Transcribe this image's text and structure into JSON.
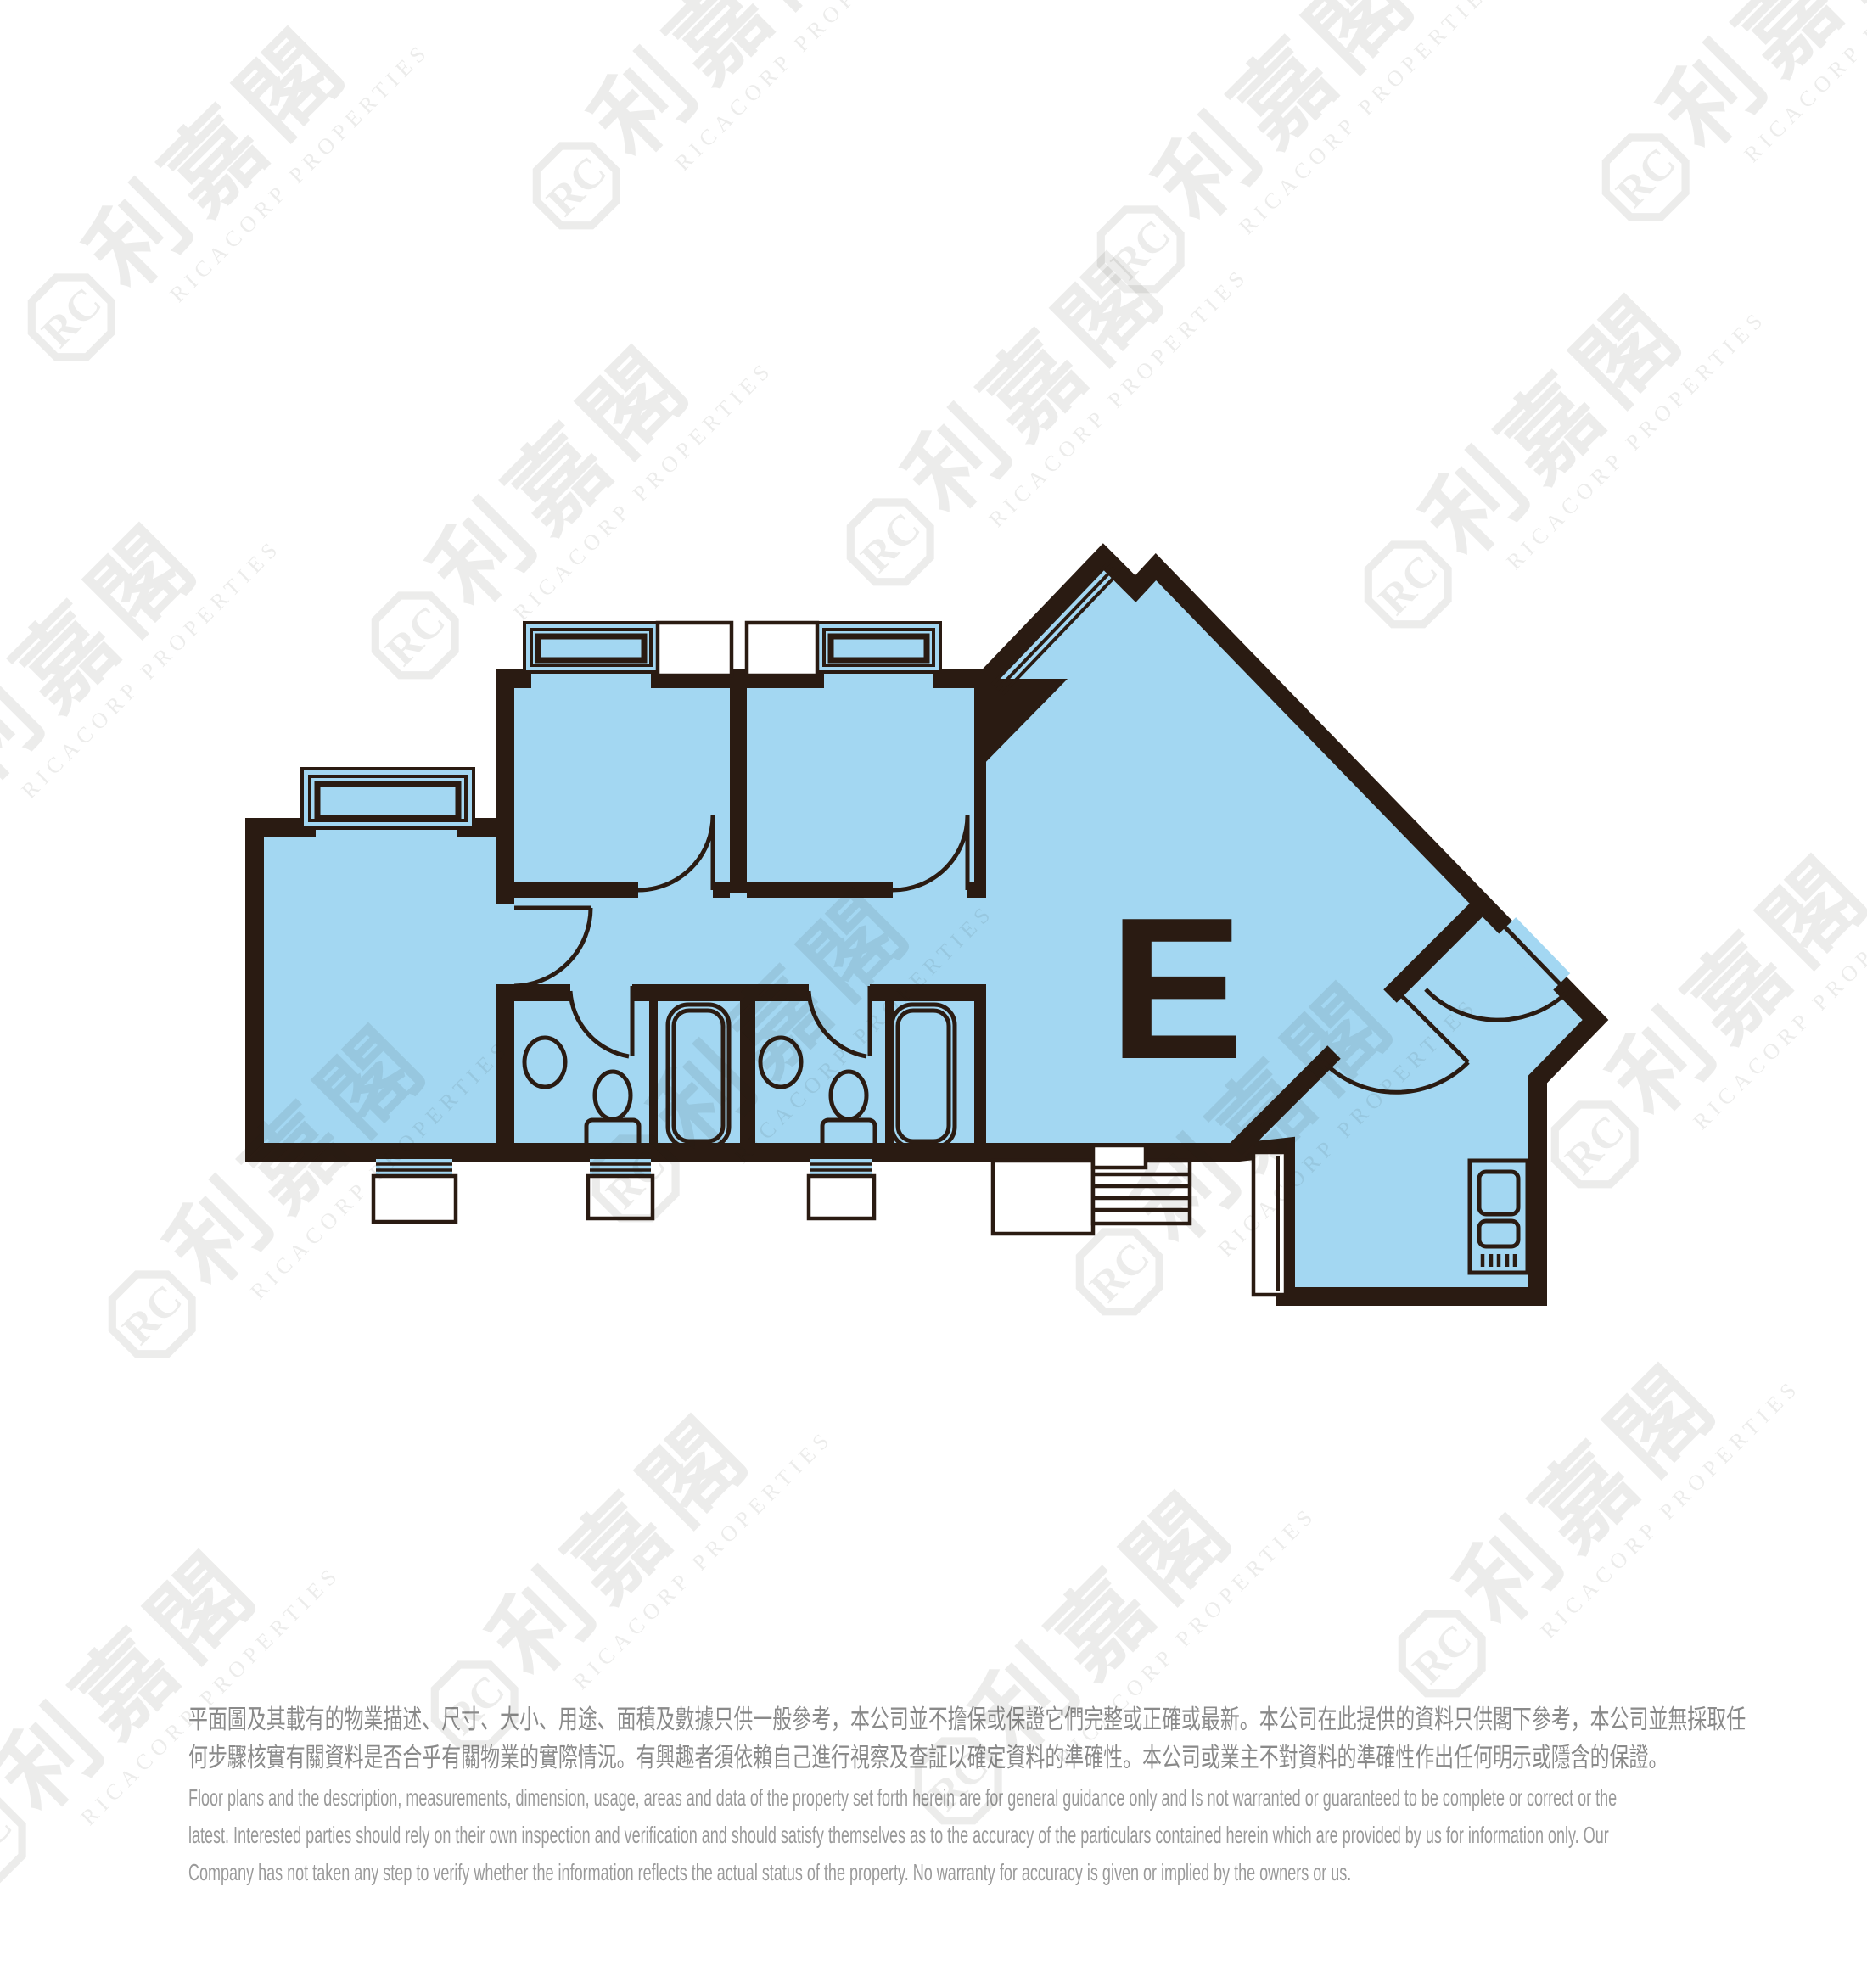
{
  "watermark": {
    "cjk": "利嘉閣",
    "latin": "RICACORP PROPERTIES",
    "logo_monogram": "RC"
  },
  "plan": {
    "unit_label": "E",
    "fill_color": "#A3D7F2",
    "wall_color": "#2A1B12"
  },
  "disclaimer": {
    "zh_lines": [
      "平面圖及其載有的物業描述、尺寸、大小、用途、面積及數據只供一般參考，本公司並不擔保或保證它們完整或正確或最新。本公司在此提供的資料只供閣下參考，本公司並無採取任",
      "何步驟核實有關資料是否合乎有關物業的實際情況。有興趣者須依賴自己進行視察及查証以確定資料的準確性。本公司或業主不對資料的準確性作出任何明示或隱含的保證。"
    ],
    "en_lines": [
      "Floor plans and the description, measurements, dimension, usage, areas and data of the property set forth herein are for general guidance only and Is not warranted or guaranteed to be complete or correct or the",
      "latest. Interested parties should rely on their own inspection and verification and should satisfy themselves as to the accuracy of the particulars contained herein which are provided by us for information only.  Our",
      "Company has not taken any step to verify whether the information reflects the actual status of the property.  No warranty for accuracy is given or implied by the owners or us."
    ]
  }
}
